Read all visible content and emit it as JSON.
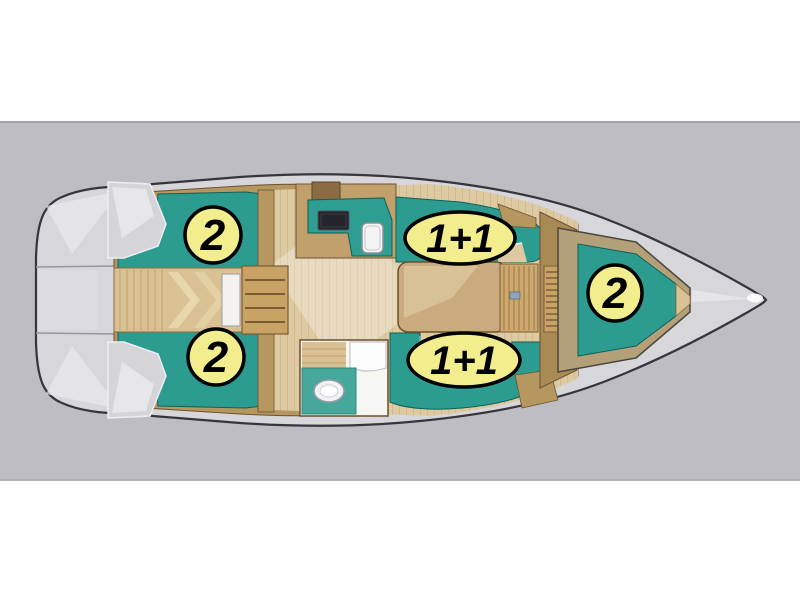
{
  "diagram": {
    "type": "sailboat-interior-floor-plan-top-view-bow-right",
    "badges": [
      {
        "area": "aft-port-cabin",
        "label": "2"
      },
      {
        "area": "aft-starboard-cabin",
        "label": "2"
      },
      {
        "area": "saloon-port-settee",
        "label": "1+1"
      },
      {
        "area": "saloon-starboard-settee",
        "label": "1+1"
      },
      {
        "area": "forward-cabin",
        "label": "2"
      }
    ],
    "colors": {
      "page_background": "#ffffff",
      "band_background": "#bdbdc3",
      "band_edge": "#a2a2a8",
      "hull_deck": "#d7d6db",
      "hull_outline": "#35353b",
      "cushion_teal": "#2d9c90",
      "cushion_teal_dark": "#0e6059",
      "wood_floor": "#decaa2",
      "wood_trim": "#b5975f",
      "wood_dark": "#6b5230",
      "badge_fill": "#f2ee8e",
      "badge_border": "#000000",
      "badge_text": "#000000"
    }
  }
}
